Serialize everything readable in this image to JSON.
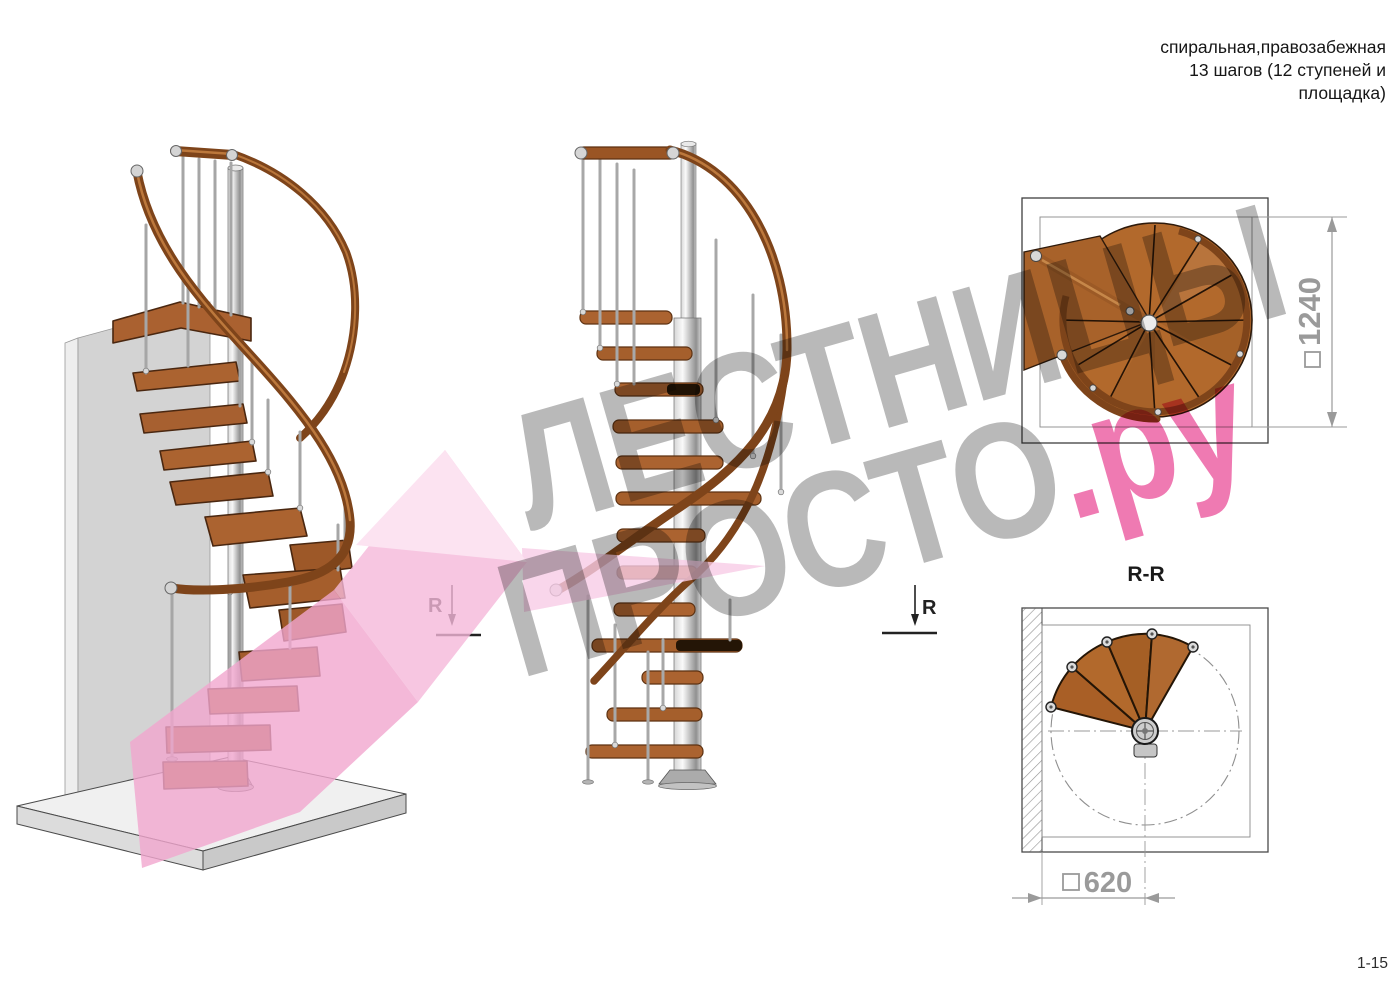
{
  "header": {
    "lines": [
      "спиральная,правозабежная",
      "13 шагов (12 ступеней и",
      "площадка)"
    ]
  },
  "watermark": {
    "line1": "ЛЕСТНИЦЫ",
    "line2_main": "ПРОСТО",
    "line2_suffix": ".ру"
  },
  "plan_view": {
    "dimension": "1240"
  },
  "section_view": {
    "title": "R-R",
    "dimension": "620"
  },
  "cut_markers": {
    "left": "R",
    "right": "R"
  },
  "page_number": "1-15",
  "colors": {
    "wood": "#ab6330",
    "handrail": "#7e441a",
    "metal": "#c9c9c9",
    "watermark_gray": "#b9b9b9",
    "watermark_pink": "#ef7ab2",
    "pink_fill": "#f2a6cf",
    "dimension_gray": "#9a9a9a"
  }
}
